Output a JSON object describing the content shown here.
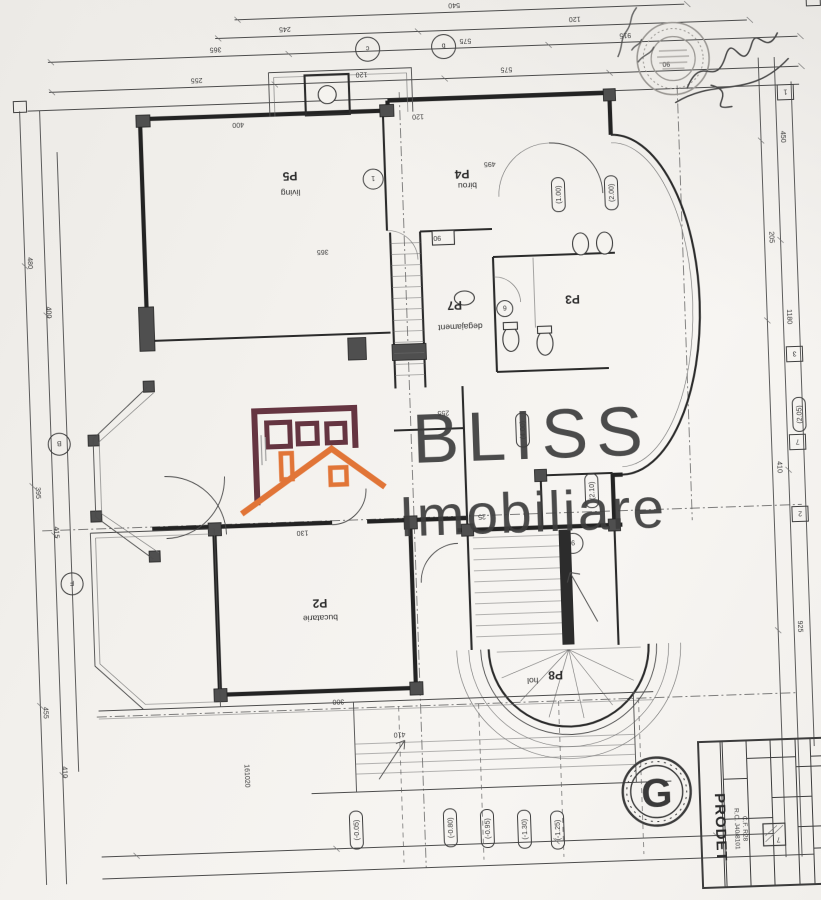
{
  "watermark": {
    "line1": "BLISS",
    "line2": "Imobiliare",
    "colors": {
      "walls": "#5a2532",
      "roof": "#e06b28",
      "text": "#3d3d3d"
    }
  },
  "rooms": [
    {
      "id": "P5",
      "name": "living"
    },
    {
      "id": "P4",
      "name": "birou"
    },
    {
      "id": "P7",
      "name": "degajament"
    },
    {
      "id": "P3",
      "name": ""
    },
    {
      "id": "P2",
      "name": "bucatarie"
    },
    {
      "id": "P8",
      "name": "hol"
    }
  ],
  "levels": {
    "l1": "(-0.05)",
    "l2": "(-0.80)",
    "l3": "(-0.95)",
    "l4": "(-1.30)",
    "l5": "(-1.25)"
  },
  "grid": {
    "right": {
      "g1": "1",
      "g2": "3",
      "g3": "7",
      "g4": "2"
    },
    "left": {
      "g1": "B",
      "g2": "F"
    },
    "top": {
      "g1": "c",
      "g2": "b"
    },
    "inner": {
      "g1": "1",
      "g2": "9",
      "g3": "6"
    }
  },
  "title_block": {
    "company": "PRODET",
    "reg1": "R.C. J40/8101",
    "reg2": "C.F. R28",
    "detail": "7"
  },
  "logo_letter": "G",
  "lot_number": "161020",
  "ovals": {
    "o1": "(2.00)",
    "o2": "(1.00)",
    "o3": "(4.00)",
    "o4": "(2.10)",
    "o5": "(2.05)"
  },
  "dims": {
    "d1": "540",
    "d2": "245",
    "d3": "120",
    "d4": "575",
    "d5": "365",
    "d6": "915",
    "d7": "255",
    "d8": "120",
    "d9": "575",
    "d10": "90",
    "d11": "450",
    "d12": "205",
    "d13": "1180",
    "d14": "410",
    "d15": "925",
    "d17": "480",
    "d18": "400",
    "d19": "395",
    "d20": "415",
    "d21": "455",
    "d22": "410",
    "d23": "400",
    "d24": "120",
    "d25": "495",
    "d26": "365",
    "d27": "90",
    "d28": "255",
    "d29": "130",
    "d30": "300",
    "d31": "410",
    "d32": "25"
  }
}
